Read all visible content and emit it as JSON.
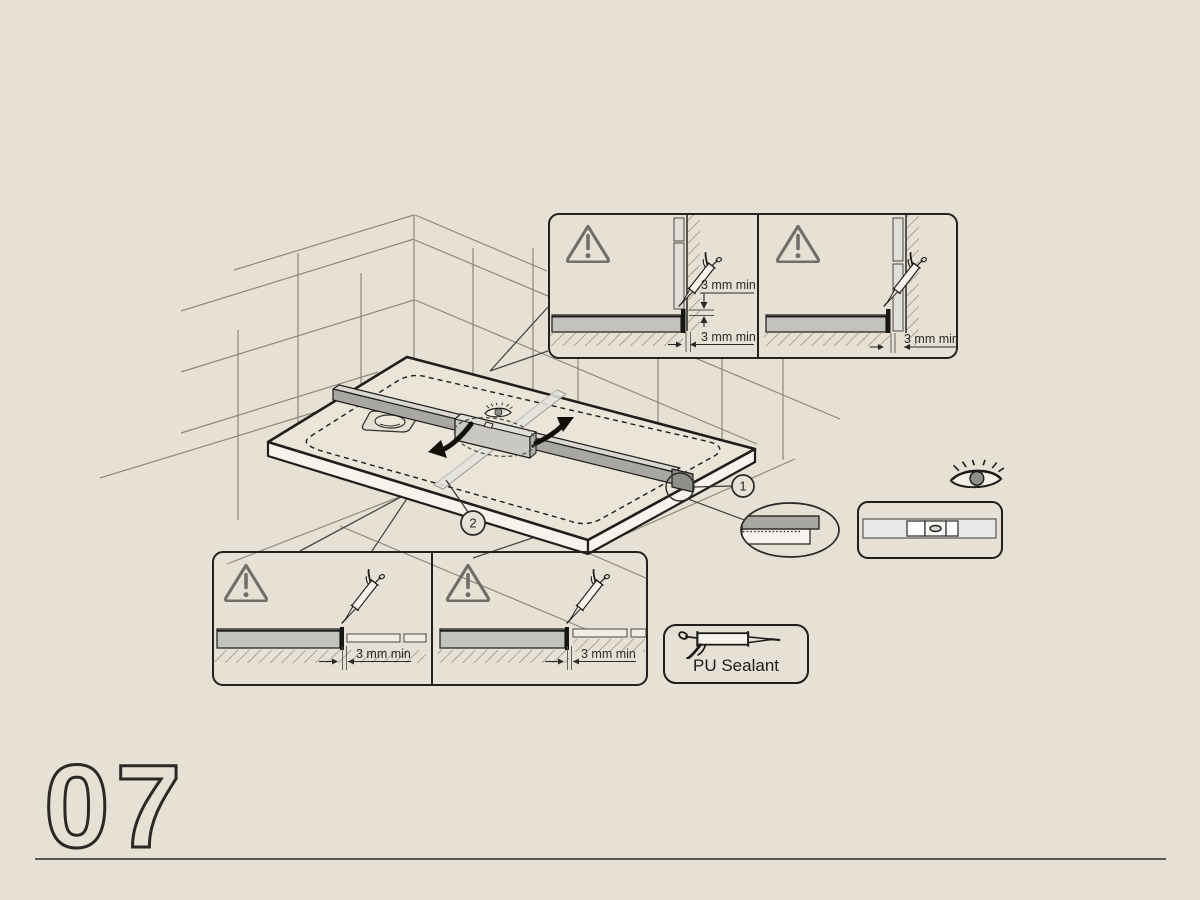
{
  "step": {
    "number": "07"
  },
  "dimensions": {
    "min_gap_label": "3 mm min"
  },
  "materials": {
    "sealant_label": "PU Sealant"
  },
  "callouts": {
    "level": "1",
    "crosswise": "2"
  },
  "colors": {
    "background": "#e7e0d4",
    "ink": "#1f1e1b",
    "soft_line": "#8f897d",
    "warning_gray": "#6f6e69",
    "level_gray": "#a8a7a2",
    "tray_section_gray": "#c3c2bd",
    "tray_side": "#f6f3ec"
  },
  "icons": {
    "warning": "warning-triangle-icon",
    "caulking_gun": "caulking-gun-icon",
    "eye": "eye-icon",
    "spirit_level": "spirit-level-icon",
    "bubble_vial": "bubble-vial-icon",
    "detail_magnifier": "detail-ellipse",
    "rotation_arrows": "rotation-arrow-icons"
  }
}
